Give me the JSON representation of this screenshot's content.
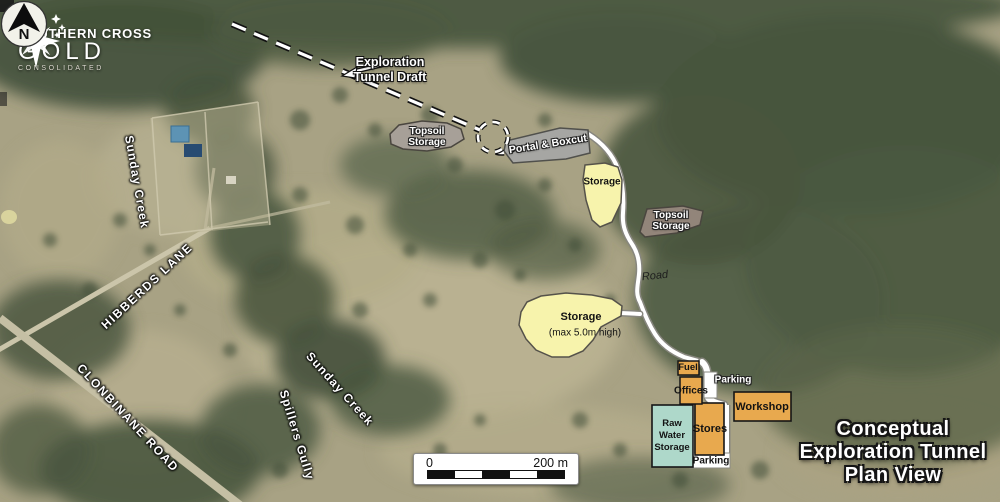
{
  "logo": {
    "top": "SOUTHERN CROSS",
    "main": "GOLD",
    "sub": "CONSOLIDATED"
  },
  "compass": {
    "n": "N"
  },
  "annotations": {
    "tunnel_line1": "Exploration",
    "tunnel_line2": "Tunnel Draft",
    "topsoil_upper": "Topsoil Storage",
    "portal_boxcut": "Portal & Boxcut",
    "storage_upper": "Storage",
    "topsoil_lower": "Topsoil Storage",
    "road": "Road",
    "storage_main": "Storage",
    "storage_main_sub": "(max 5.0m high)",
    "fuel": "Fuel",
    "offices": "Offices",
    "parking_upper": "Parking",
    "workshop": "Workshop",
    "raw_water": "Raw Water Storage",
    "stores": "Stores",
    "parking_lower": "Parking"
  },
  "geo": {
    "sunday_creek_upper": "Sunday Creek",
    "hibberds_lane": "HIBBERDS LANE",
    "clonbinane_road": "CLONBINANE ROAD",
    "sunday_creek_lower": "Sunday Creek",
    "spillers_gully": "Spillers Gully"
  },
  "scalebar": {
    "zero": "0",
    "max": "200 m"
  },
  "title": {
    "line1": "Conceptual",
    "line2": "Exploration Tunnel",
    "line3": "Plan View"
  },
  "colors": {
    "storage_fill": "#f7f3ac",
    "topsoil_upper_fill": "#a7a098",
    "topsoil_lower_fill": "#92857a",
    "portal_fill": "#a6a6a3",
    "building_fill": "#e8a94e",
    "water_tank_fill": "#aed8ca",
    "road_fill": "#ffffff"
  }
}
